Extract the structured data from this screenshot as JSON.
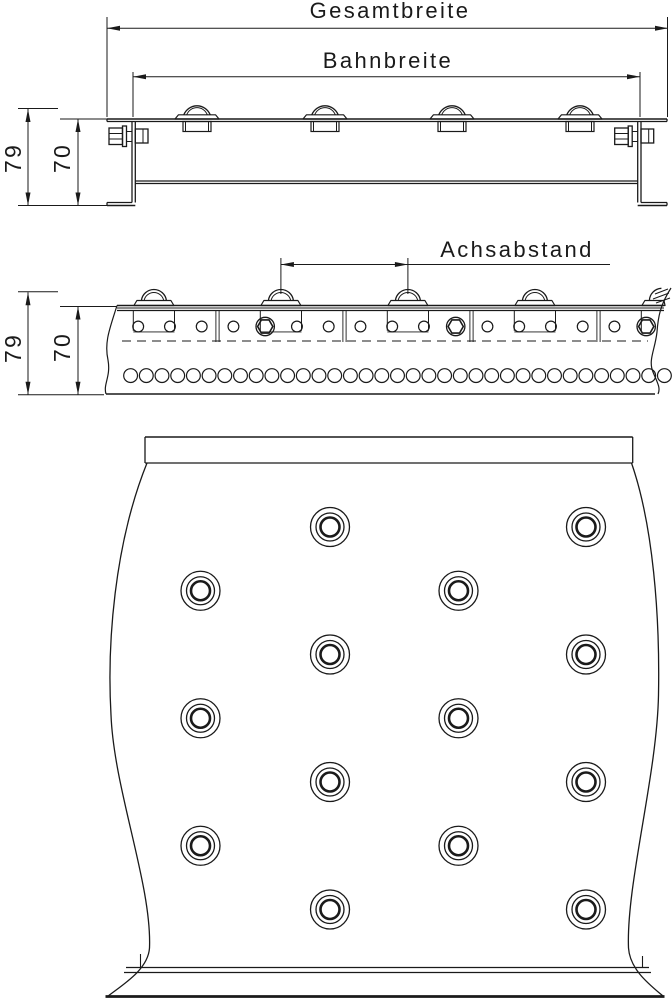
{
  "drawing": {
    "labels": {
      "gesamtbreite": "Gesamtbreite",
      "bahnbreite": "Bahnbreite",
      "achsabstand": "Achsabstand",
      "height_total": "79",
      "height_track": "70"
    },
    "colors": {
      "line": "#1a1a1a",
      "background": "#ffffff"
    },
    "front_view": {
      "outer_left": 107,
      "outer_right": 667,
      "top_y": 119,
      "top_y2": 121.5,
      "web_left": [
        132,
        135.3
      ],
      "web_right": [
        637.7,
        641
      ],
      "rail_bottom": [
        181,
        183.5
      ],
      "foot_top": 202.5,
      "foot_bottom": 205.5,
      "balls_x": [
        197,
        325,
        452,
        580
      ],
      "ball": {
        "cup_half_w": 14,
        "cup_top": 121.5,
        "cup_bottom": 131.5,
        "cup_inner_half_w": 11.5,
        "plate_half_w_bottom": 22,
        "plate_half_w_top": 18.5,
        "plate_top_y": 114.8,
        "dome_r": 14.2,
        "dome_chord_half": 13.2,
        "dome_inner_r": 11,
        "dome_inner_chord_half": 10.3
      },
      "bolt": {
        "nut_w": 13.5,
        "nut_top": 128,
        "nut_bottom": 144.5,
        "facet_y": [
          133.5,
          139
        ],
        "washer_w": 4,
        "washer_top": 126,
        "washer_bottom": 146.5,
        "shank_y": [
          131.5,
          141.5
        ],
        "head_w": 12.7,
        "head_top": 129,
        "head_bottom": 143
      }
    },
    "side_view": {
      "band_y": [
        305.5,
        308,
        310.5
      ],
      "band_x": [
        117,
        664
      ],
      "bottom_y": 394,
      "bottom_x": [
        106,
        655
      ],
      "balls_x": [
        153.9,
        280.9,
        407.9,
        534.9
      ],
      "partial_ball_x": 661.9,
      "ball": {
        "plate_half_w": 20,
        "plate_half_w_top": 17,
        "plate_top_y": 300.5,
        "plate_bottom_y": 305.5,
        "dome_r": 12.6,
        "dome_chord_half": 12.5,
        "dome_inner_r": 10,
        "dome_inner_chord_half": 9.8
      },
      "bracket": {
        "half_w": 20.6,
        "top_y": 310.5,
        "bottom_y": 330.8,
        "u_y": 331.9
      },
      "hole_row": {
        "start_x": 138.2,
        "pitch": 31.75,
        "count": 17,
        "cy": 326.5,
        "r": 5.4,
        "hex_indices": [
          4,
          10,
          16
        ],
        "hex_outer_r": 9.2,
        "hex_r": 7.6
      },
      "bottom_row": {
        "start_x": 130.6,
        "pitch": 15.7,
        "count": 35,
        "cy": 375.6,
        "r": 6.9
      },
      "separators_x": [
        217.5,
        344.5,
        471.5,
        598.5
      ],
      "dashed_line_y": 341
    },
    "plan_view": {
      "band": {
        "x1": 145,
        "x2": 632.7,
        "y1": 437,
        "y2": 463
      },
      "columns_outer_x": [
        330,
        586
      ],
      "rows_outer_y": [
        527,
        654.5,
        782,
        909.5
      ],
      "columns_inner_x": [
        200.5,
        458.5
      ],
      "rows_inner_y": [
        590.75,
        718.25,
        845.75
      ],
      "ball_radii": [
        19.5,
        14,
        9.5
      ],
      "footer": {
        "line1_y": 967.5,
        "line2_y": 972.5,
        "x1": 126,
        "x2": 649,
        "bottom_y": 996.5,
        "bottom_x1": 105.5,
        "bottom_x2": 664.5,
        "tick_left_x": 140.5,
        "tick_right_x": 642.5,
        "tick_top_y": 954
      }
    },
    "dimensions": {
      "gesamtbreite": {
        "y": 28.3,
        "x1": 107,
        "x2": 668,
        "ext_top": 17,
        "ext_bottom": 117,
        "text_x": 390,
        "text_y": 18
      },
      "bahnbreite": {
        "y": 76.7,
        "x1": 133,
        "x2": 640,
        "ext_top": 72,
        "ext_bottom": 117,
        "text_x": 388,
        "text_y": 68
      },
      "achsabstand": {
        "y": 264.5,
        "x1": 280.9,
        "x2": 407.9,
        "line_end_x": 610,
        "ext_top": 258,
        "ext_bottom": 294,
        "text_x": 517,
        "text_y": 257
      },
      "front_79": {
        "x": 28,
        "y1": 109,
        "y2": 205.5,
        "ext_top_y": 108.5,
        "ext_top_x": [
          18,
          58
        ],
        "ext_bot_y": 205.5,
        "ext_bot_x": [
          18,
          107
        ],
        "label_tx": 21,
        "label_ty": 158
      },
      "front_70": {
        "x": 78,
        "y1": 119,
        "y2": 205.5,
        "ext_top_y": 119,
        "ext_top_x": [
          60,
          107
        ],
        "label_tx": 70,
        "label_ty": 158
      },
      "side_79": {
        "x": 28,
        "y1": 292.2,
        "y2": 394.8,
        "ext_top_y": 291.8,
        "ext_top_x": [
          18,
          58
        ],
        "ext_bot_y": 394.8,
        "ext_bot_x": [
          18,
          104
        ],
        "label_tx": 21,
        "label_ty": 348
      },
      "side_70": {
        "x": 78,
        "y1": 306.5,
        "y2": 394.8,
        "ext_top_y": 306.5,
        "ext_top_x": [
          60,
          117
        ],
        "label_tx": 70,
        "label_ty": 347
      }
    }
  }
}
